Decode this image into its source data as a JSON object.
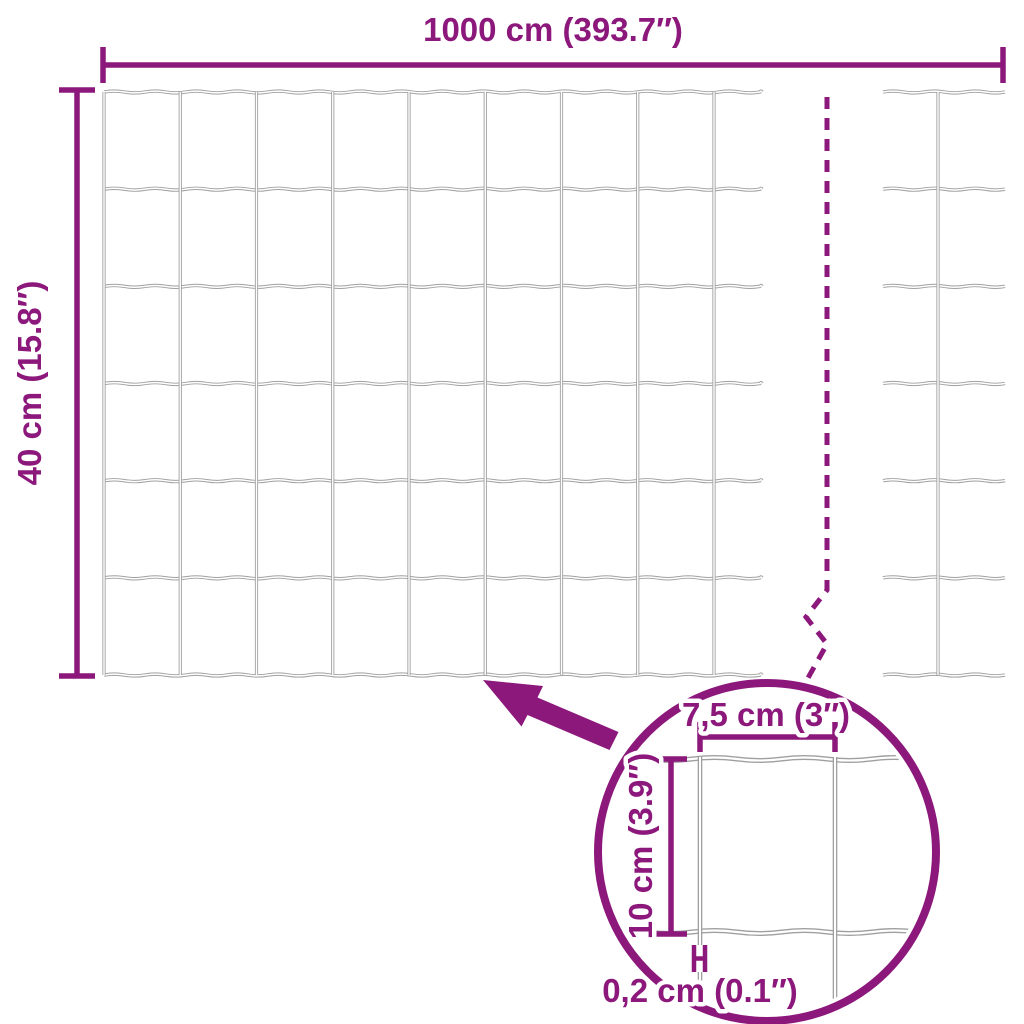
{
  "diagram": {
    "subject": "garden-mesh-fence-dimension-diagram",
    "colors": {
      "accent": "#8C187C",
      "wire": "#A0A0A0",
      "background": "#FFFFFF"
    },
    "dimensions": {
      "total_width": {
        "label": "1000 cm (393.7″)",
        "value_cm": 1000
      },
      "total_height": {
        "label": "40 cm (15.8″)",
        "value_cm": 40
      },
      "mesh_cell_width": {
        "label": "7,5 cm (3″)",
        "value_cm": 7.5
      },
      "mesh_cell_height": {
        "label": "10 cm (3.9″)",
        "value_cm": 10
      },
      "wire_thickness": {
        "label": "0,2 cm (0.1″)",
        "value_cm": 0.2
      }
    },
    "mesh": {
      "main_columns": 8,
      "main_rows": 6,
      "fragment_columns": 1
    }
  }
}
